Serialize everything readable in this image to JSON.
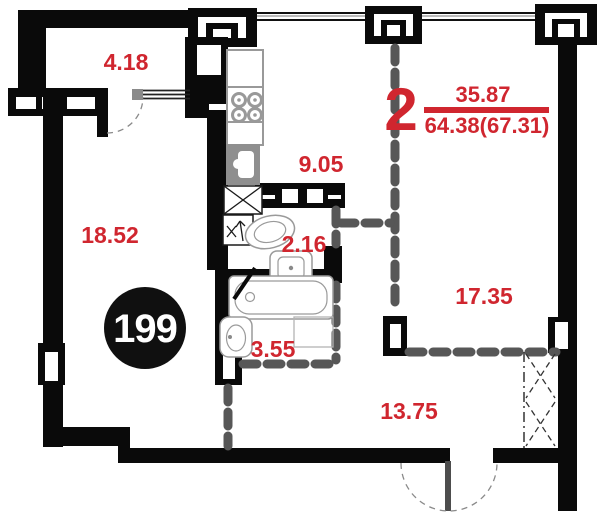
{
  "plan": {
    "badge_number": "199",
    "title": {
      "rooms_count": "2",
      "living_area": "35.87",
      "total_area": "64.38(67.31)"
    },
    "areas": {
      "balcony": "4.18",
      "living_room": "18.52",
      "kitchen": "9.05",
      "wc": "2.16",
      "bathroom": "3.55",
      "bedroom": "17.35",
      "hall": "13.75"
    },
    "colors": {
      "accent_red": "#d0262f",
      "wall_black": "#0a0a0a",
      "partition_gray": "#575757"
    }
  }
}
